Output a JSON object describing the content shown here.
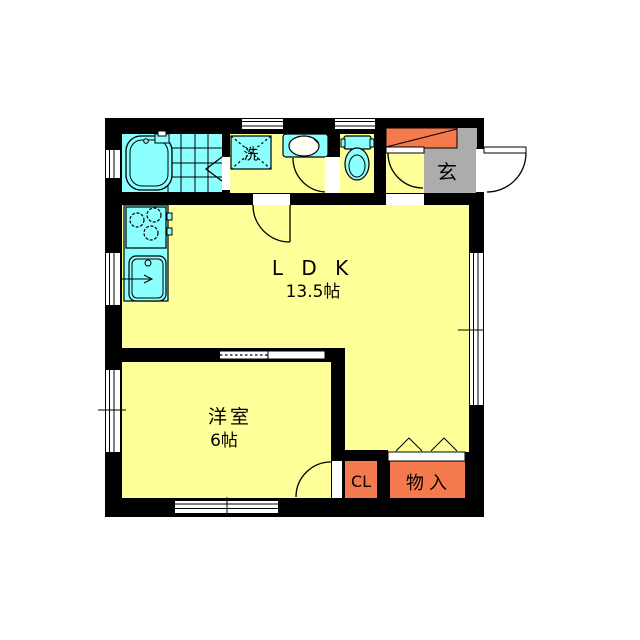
{
  "plan": {
    "type": "floor-plan",
    "labels": {
      "ldk_name": "L D K",
      "ldk_size": "13.5帖",
      "western_room_name": "洋室",
      "western_room_size": "6帖",
      "closet": "CL",
      "storage": "物入",
      "entrance": "玄",
      "laundry": "洗"
    },
    "colors": {
      "floor": "#FFFF99",
      "fixture": "#8CFFFF",
      "closet_orange": "#F4794D",
      "entrance_gray": "#ACACAC",
      "wall": "#000000",
      "background": "#FFFFFF"
    },
    "fixtures": [
      "bathtub-icon",
      "bath-tile-floor",
      "washing-machine-pan-icon",
      "washbasin-icon",
      "toilet-icon",
      "stove-icon",
      "kitchen-sink-icon",
      "shoe-cabinet-icon"
    ]
  }
}
